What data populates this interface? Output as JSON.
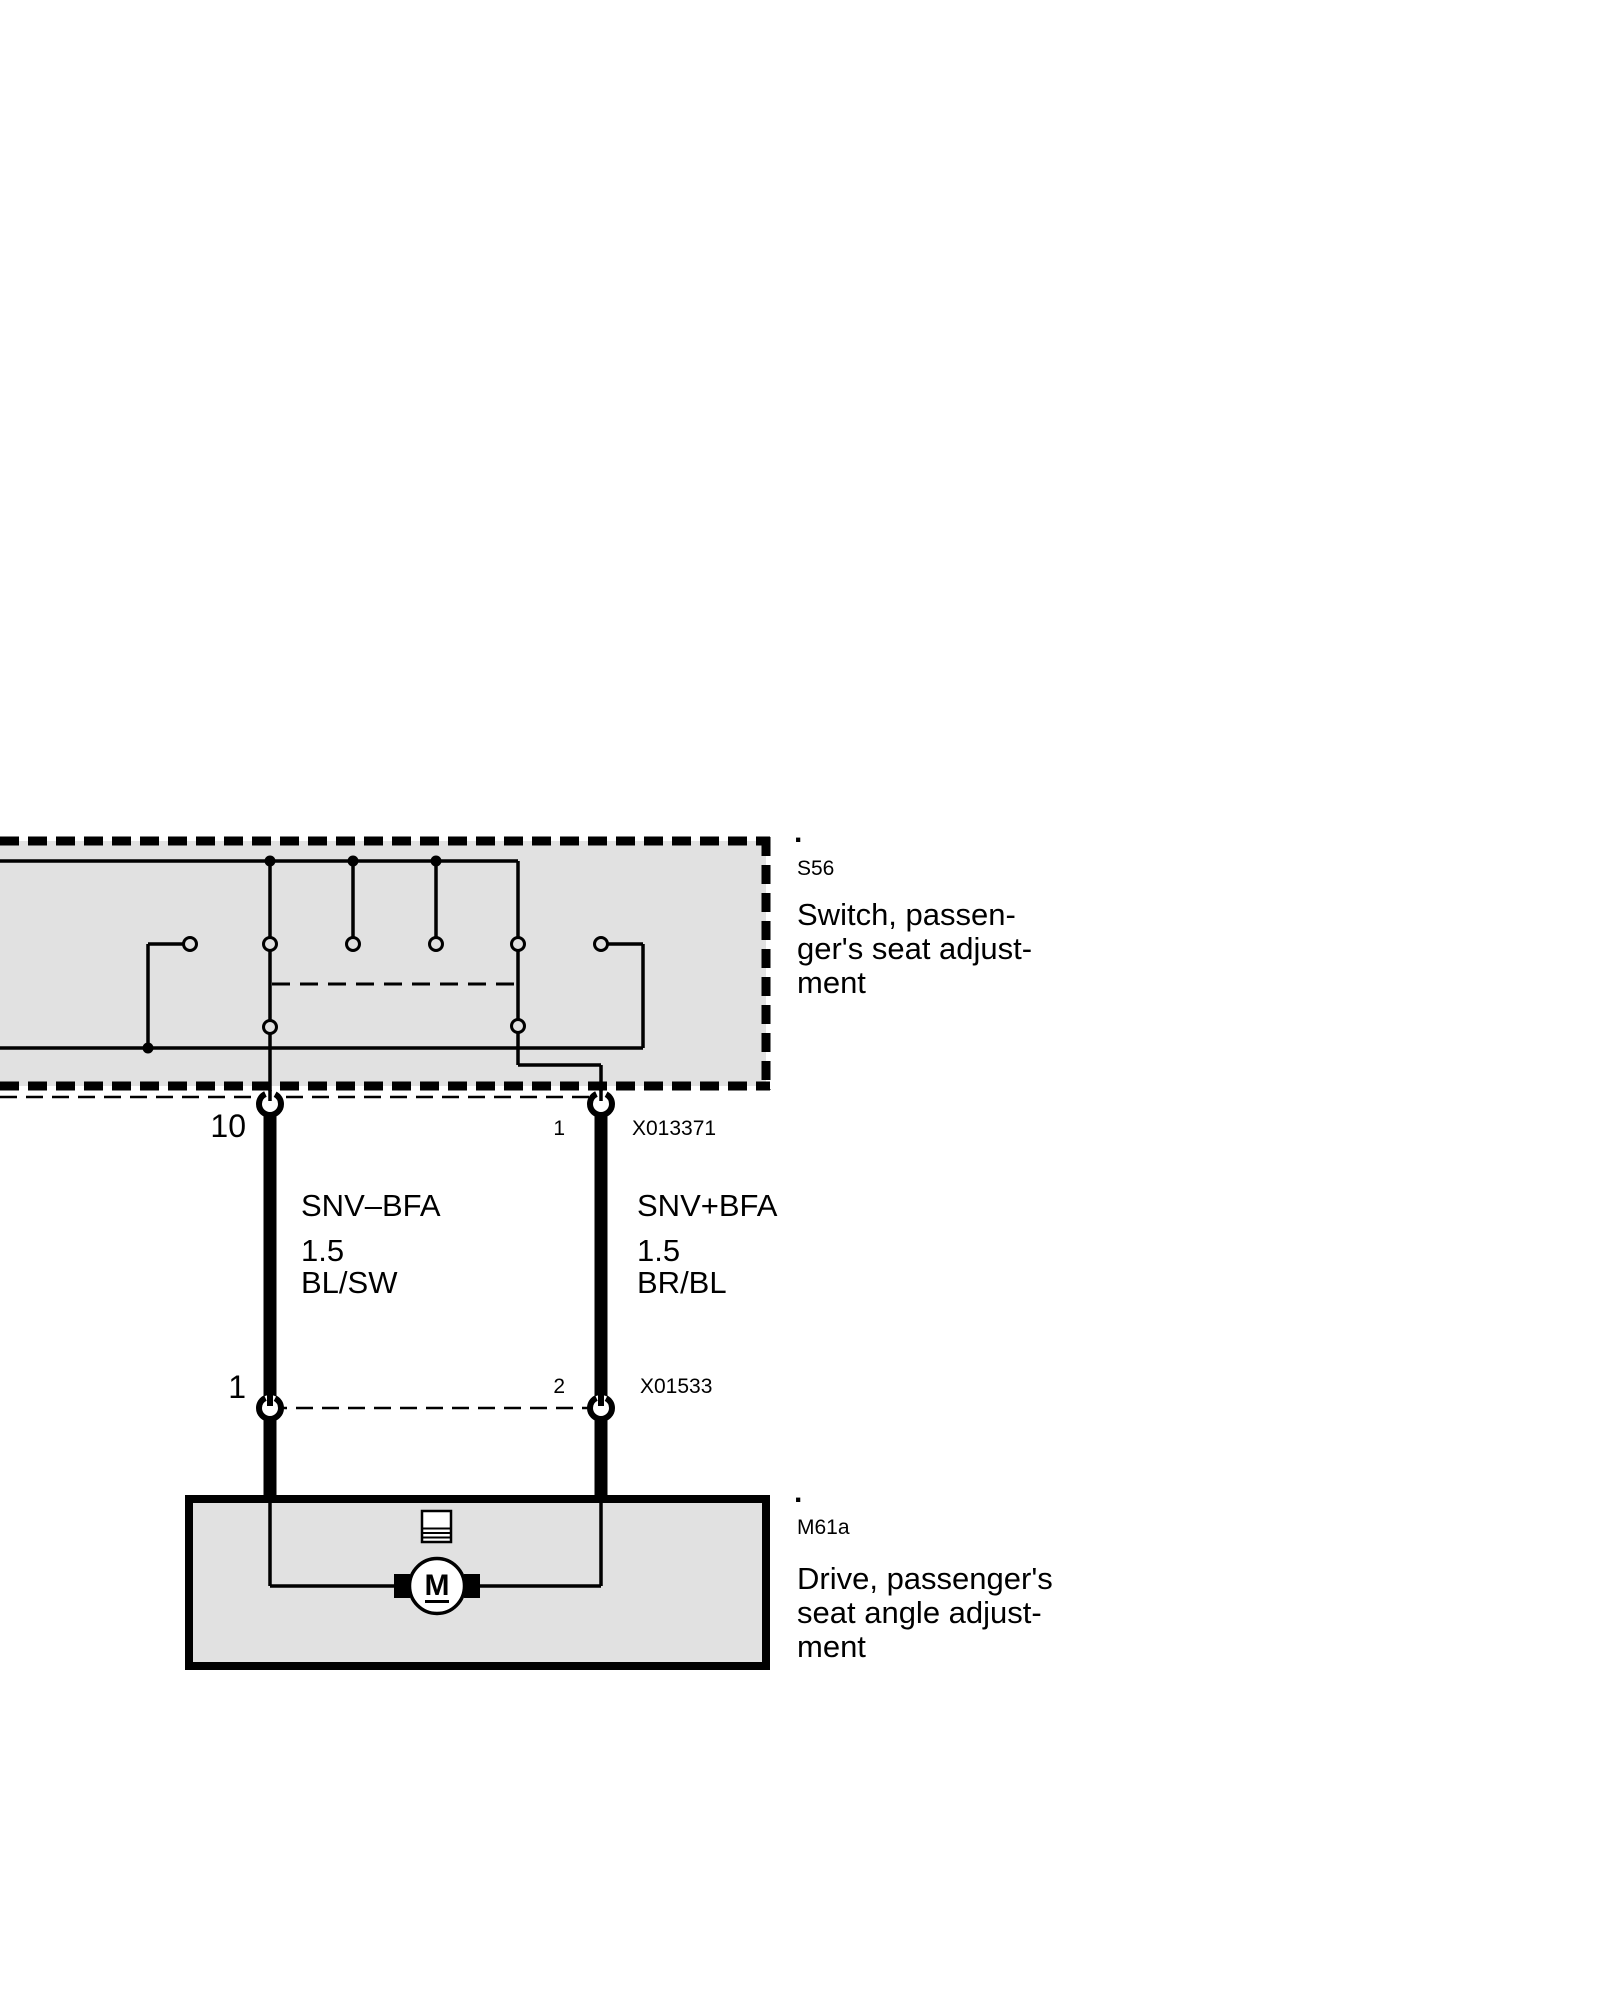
{
  "colors": {
    "box_fill": "#e1e1e1",
    "line": "#000000",
    "background": "#ffffff"
  },
  "switch_box": {
    "ref_dot": ".",
    "code": "S56",
    "label_lines": [
      "Switch, passen-",
      "ger's seat adjust-",
      "ment"
    ]
  },
  "motor_box": {
    "ref_dot": ".",
    "code": "M61a",
    "label_lines": [
      "Drive, passenger's",
      "seat angle adjust-",
      "ment"
    ],
    "motor_letter": "M"
  },
  "connectors": {
    "upper": {
      "left_pin": "10",
      "right_pin": "1",
      "code": "X013371"
    },
    "lower": {
      "left_pin": "1",
      "right_pin": "2",
      "code": "X01533"
    }
  },
  "wires": {
    "left": {
      "name": "SNV–BFA",
      "size": "1.5",
      "color_code": "BL/SW"
    },
    "right": {
      "name": "SNV+BFA",
      "size": "1.5",
      "color_code": "BR/BL"
    }
  }
}
